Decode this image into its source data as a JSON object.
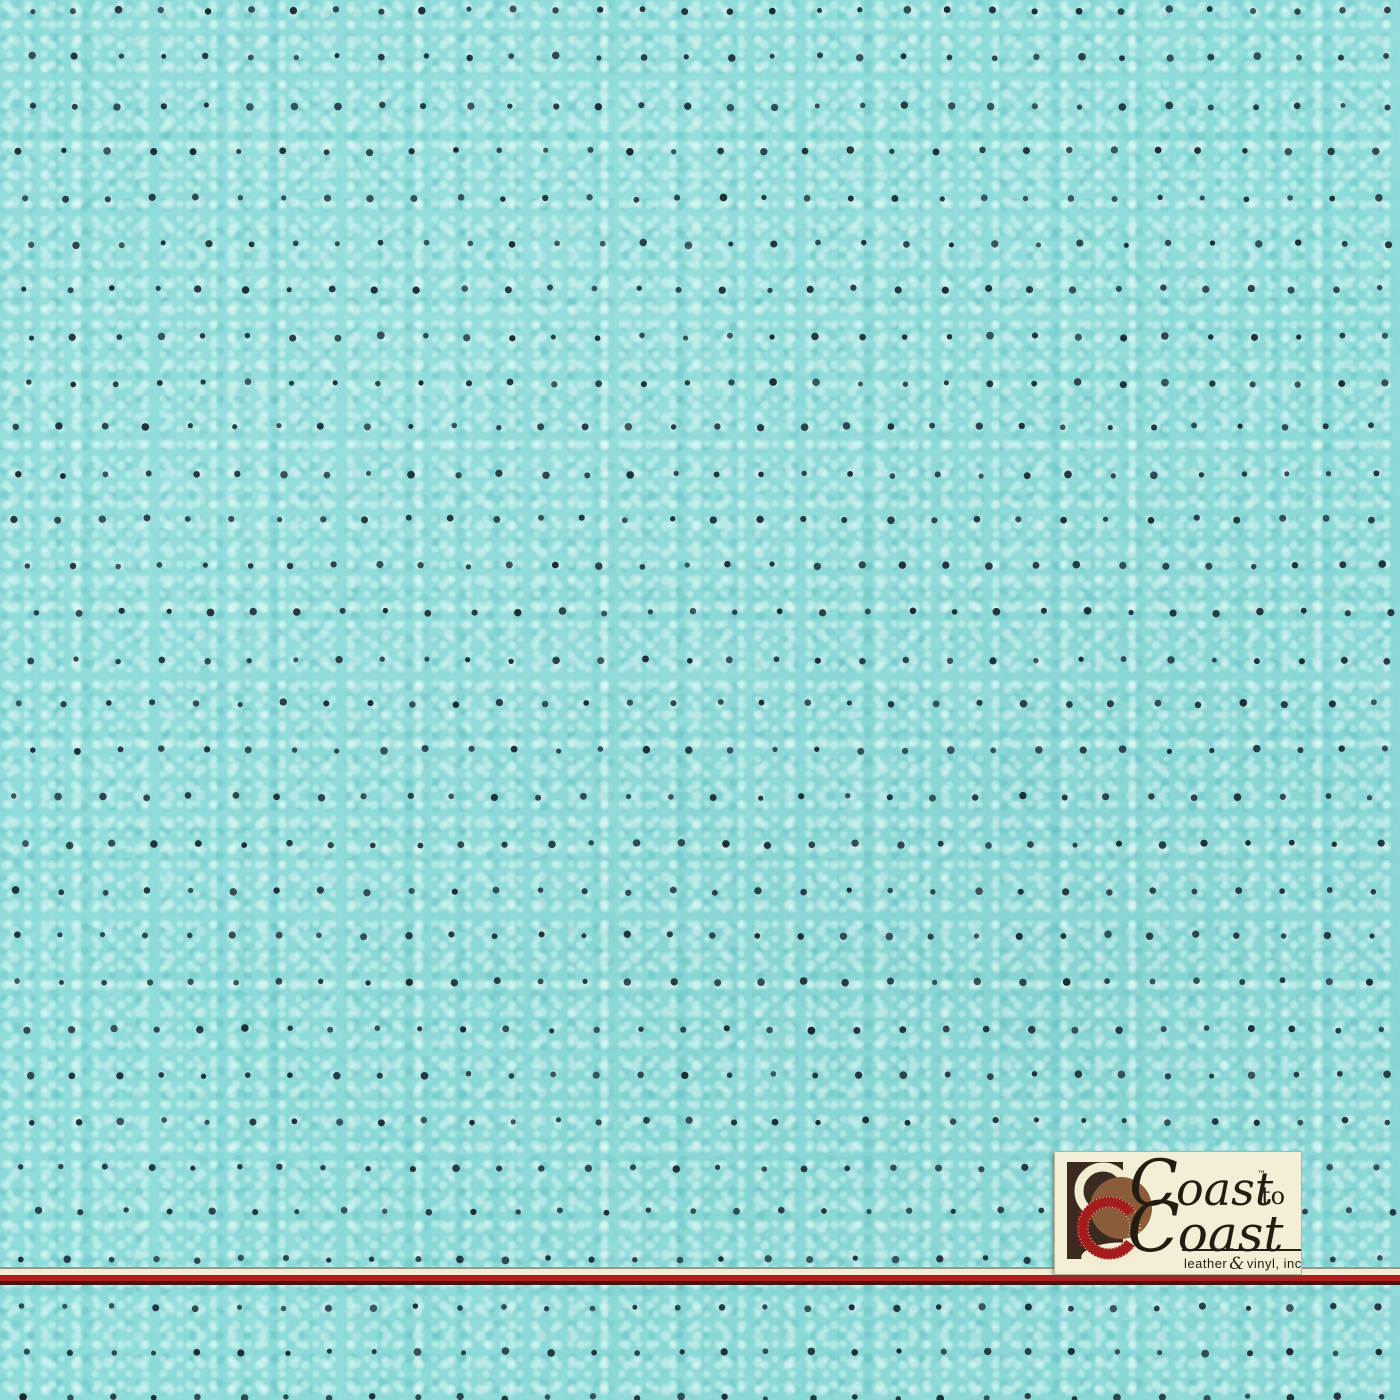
{
  "material": {
    "base_color": "#84d8d6",
    "pebble_highlight": "#dcfcf5",
    "pebble_shadow": "#4fb3b6",
    "perforation": {
      "dot_color": "#1c2a34",
      "rows": 31,
      "cols": 33,
      "spacing_x": 43.7,
      "spacing_y": 46.2,
      "offset_x": 26,
      "offset_y": 12,
      "dot_radius": 3.1
    }
  },
  "divider": {
    "edge_color": "#97988a",
    "cream_color": "#f1ecd2",
    "red_color": "#b11d1c",
    "dark_red_color": "#47150e"
  },
  "logo": {
    "background_color": "#f3eed6",
    "text_color": "#241c11",
    "word1": "Coast",
    "trademark": "™",
    "connector": "to",
    "word2": "Coast",
    "tagline_leather": "leather",
    "tagline_ampersand": "&",
    "tagline_rest": "vinyl, inc",
    "mark": {
      "panel_color": "#3a2a20",
      "cream_ring_color": "#f2ecd3",
      "brown_circle_color": "#8a5c3a",
      "red_ring_color": "#a41d1d"
    }
  }
}
